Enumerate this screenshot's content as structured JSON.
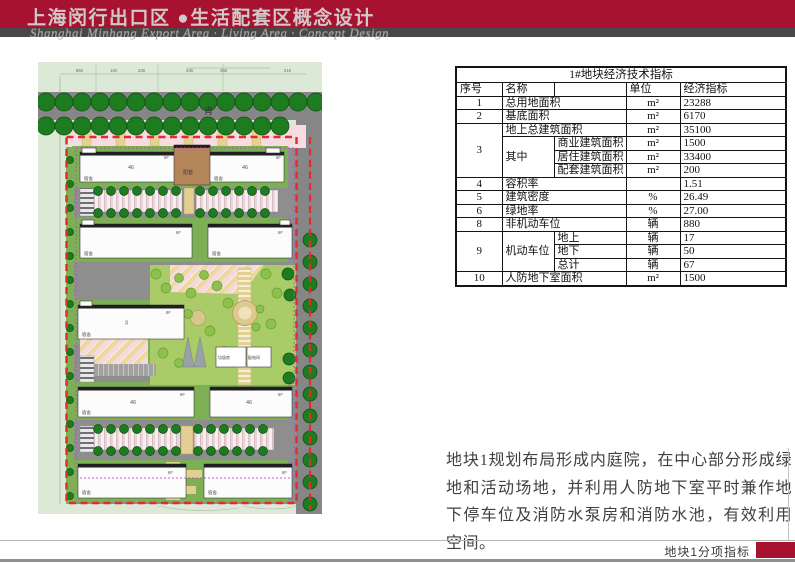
{
  "header": {
    "title_cn": "上海闵行出口区 ●生活配套区概念设计",
    "subtitle_en": "Shanghai Minhang Export Area · Living Area · Concept Design",
    "bar_color": "#a81231",
    "stripe_color": "#4a4846"
  },
  "plan": {
    "road_label": "肖",
    "dim_numbers": [
      "850",
      "140",
      "238",
      "436",
      "258",
      "216"
    ],
    "labels": {
      "dorm": "宿舍",
      "core": "配套",
      "len46": "46",
      "floors": "6F",
      "width15": "15",
      "trash_room": "垃圾房",
      "power_room": "配电间"
    }
  },
  "table": {
    "title": "1#地块经济技术指标",
    "headers": {
      "no": "序号",
      "name": "名称",
      "unit": "单位",
      "value": "经济指标"
    },
    "rows": [
      {
        "no": "1",
        "name": "总用地面积",
        "unit": "m²",
        "value": "23288"
      },
      {
        "no": "2",
        "name": "基底面积",
        "unit": "m²",
        "value": "6170"
      },
      {
        "no": "3",
        "name": "地上总建筑面积",
        "unit": "m²",
        "value": "35100"
      },
      {
        "name": "其中",
        "sub": "商业建筑面积",
        "unit": "m²",
        "value": "1500"
      },
      {
        "sub": "居住建筑面积",
        "unit": "m²",
        "value": "33400"
      },
      {
        "sub": "配套建筑面积",
        "unit": "m²",
        "value": "200"
      },
      {
        "no": "4",
        "name": "容积率",
        "unit": "",
        "value": "1.51"
      },
      {
        "no": "5",
        "name": "建筑密度",
        "unit": "%",
        "value": "26.49"
      },
      {
        "no": "6",
        "name": "绿地率",
        "unit": "%",
        "value": "27.00"
      },
      {
        "no": "8",
        "name": "非机动车位",
        "unit": "辆",
        "value": "880"
      },
      {
        "no": "9",
        "name": "机动车位",
        "sub": "地上",
        "unit": "辆",
        "value": "17"
      },
      {
        "sub": "地下",
        "unit": "辆",
        "value": "50"
      },
      {
        "sub": "总计",
        "unit": "辆",
        "value": "67"
      },
      {
        "no": "10",
        "name": "人防地下室面积",
        "unit": "m²",
        "value": "1500"
      }
    ]
  },
  "description": "地块1规划布局形成内庭院，在中心部分形成绿地和活动场地，并利用人防地下室平时兼作地下停车位及消防水泵房和消防水池，有效利用空间。",
  "footer": {
    "label": "地块1分项指标",
    "accent_color": "#a81231"
  }
}
